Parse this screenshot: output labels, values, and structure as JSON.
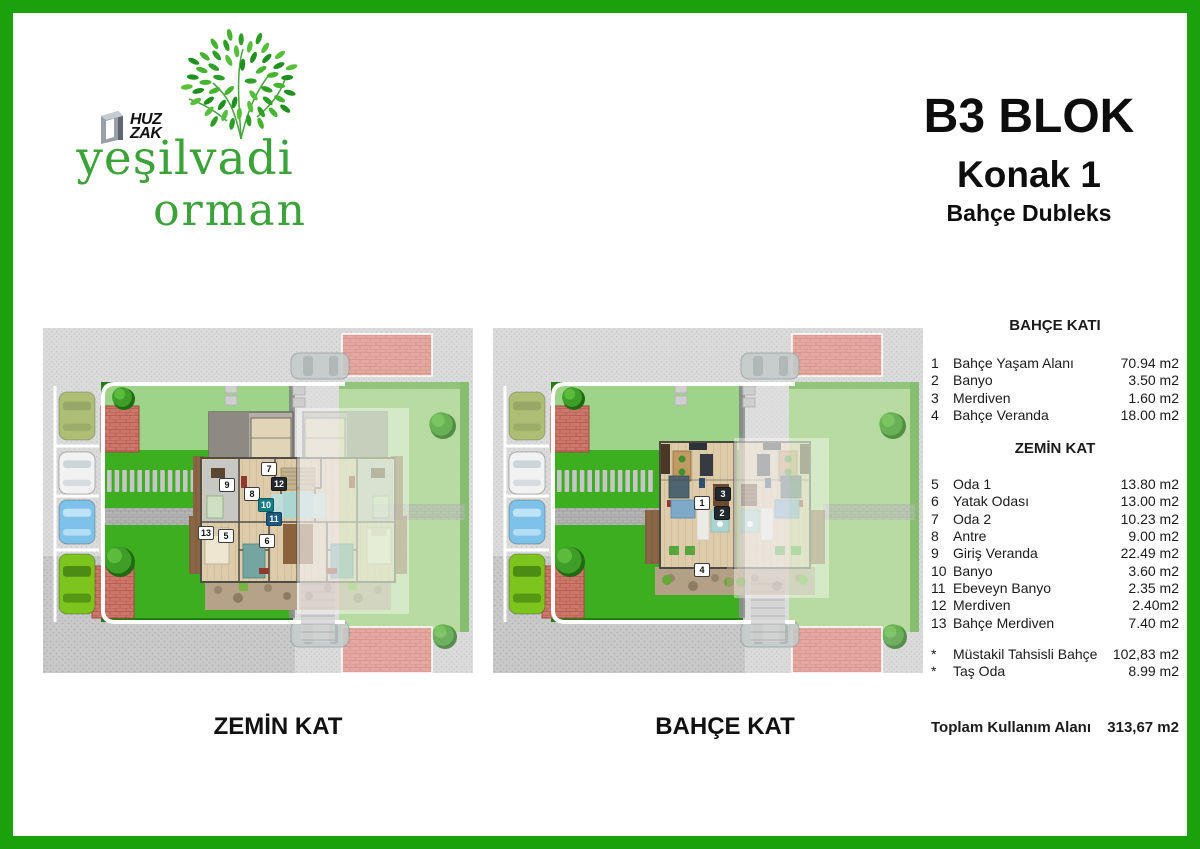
{
  "brand": {
    "logo_top1": "HUZ",
    "logo_top2": "ZAK",
    "name_line1": "yeşilvadi",
    "name_line2": "orman",
    "green": "#3ca23a"
  },
  "title": {
    "block": "B3 BLOK",
    "unit": "Konak 1",
    "type": "Bahçe Dubleks"
  },
  "plans": {
    "left": {
      "caption": "ZEMİN KAT",
      "badges": [
        {
          "n": "9",
          "x": 184,
          "y": 157,
          "variant": "light"
        },
        {
          "n": "7",
          "x": 226,
          "y": 141,
          "variant": "light"
        },
        {
          "n": "12",
          "x": 236,
          "y": 156,
          "variant": "dark"
        },
        {
          "n": "8",
          "x": 209,
          "y": 166,
          "variant": "light"
        },
        {
          "n": "10",
          "x": 223,
          "y": 177,
          "variant": "teal"
        },
        {
          "n": "11",
          "x": 231,
          "y": 191,
          "variant": "blue"
        },
        {
          "n": "13",
          "x": 163,
          "y": 205,
          "variant": "light"
        },
        {
          "n": "5",
          "x": 183,
          "y": 208,
          "variant": "light"
        },
        {
          "n": "6",
          "x": 224,
          "y": 213,
          "variant": "light"
        }
      ]
    },
    "right": {
      "caption": "BAHÇE KAT",
      "badges": [
        {
          "n": "1",
          "x": 209,
          "y": 175,
          "variant": "light"
        },
        {
          "n": "3",
          "x": 230,
          "y": 166,
          "variant": "dark"
        },
        {
          "n": "2",
          "x": 229,
          "y": 185,
          "variant": "dark"
        },
        {
          "n": "4",
          "x": 209,
          "y": 242,
          "variant": "light"
        }
      ]
    }
  },
  "schedule": {
    "sections": [
      {
        "header": "BAHÇE KATI",
        "rows": [
          {
            "no": "1",
            "name": "Bahçe Yaşam Alanı",
            "area": "70.94 m2"
          },
          {
            "no": "2",
            "name": "Banyo",
            "area": "3.50 m2"
          },
          {
            "no": "3",
            "name": "Merdiven",
            "area": "1.60 m2"
          },
          {
            "no": "4",
            "name": "Bahçe Veranda",
            "area": "18.00 m2"
          }
        ]
      },
      {
        "header": "ZEMİN KAT",
        "rows": [
          {
            "no": "5",
            "name": "Oda 1",
            "area": "13.80 m2"
          },
          {
            "no": "6",
            "name": "Yatak Odası",
            "area": "13.00 m2"
          },
          {
            "no": "7",
            "name": "Oda 2",
            "area": "10.23 m2"
          },
          {
            "no": "8",
            "name": "Antre",
            "area": "9.00 m2"
          },
          {
            "no": "9",
            "name": "Giriş Veranda",
            "area": "22.49 m2"
          },
          {
            "no": "10",
            "name": "Banyo",
            "area": "3.60 m2"
          },
          {
            "no": "11",
            "name": "Ebeveyn Banyo",
            "area": "2.35 m2"
          },
          {
            "no": "12",
            "name": "Merdiven",
            "area": "2.40m2"
          },
          {
            "no": "13",
            "name": "Bahçe Merdiven",
            "area": "7.40 m2"
          }
        ]
      }
    ],
    "extras": [
      {
        "no": "*",
        "name": "Müstakil Tahsisli Bahçe",
        "area": "102,83 m2"
      },
      {
        "no": "*",
        "name": "Taş Oda",
        "area": "8.99 m2"
      }
    ],
    "total": {
      "label": "Toplam Kullanım Alanı",
      "value": "313,67 m2"
    }
  },
  "colors": {
    "frame_green": "#1ba10b",
    "logo_green": "#3ca23a",
    "lawn_light": "#9ed489",
    "lawn_vivid": "#3cae20",
    "brick_red": "#cd776b",
    "street_gray": "#dbdbdb"
  }
}
